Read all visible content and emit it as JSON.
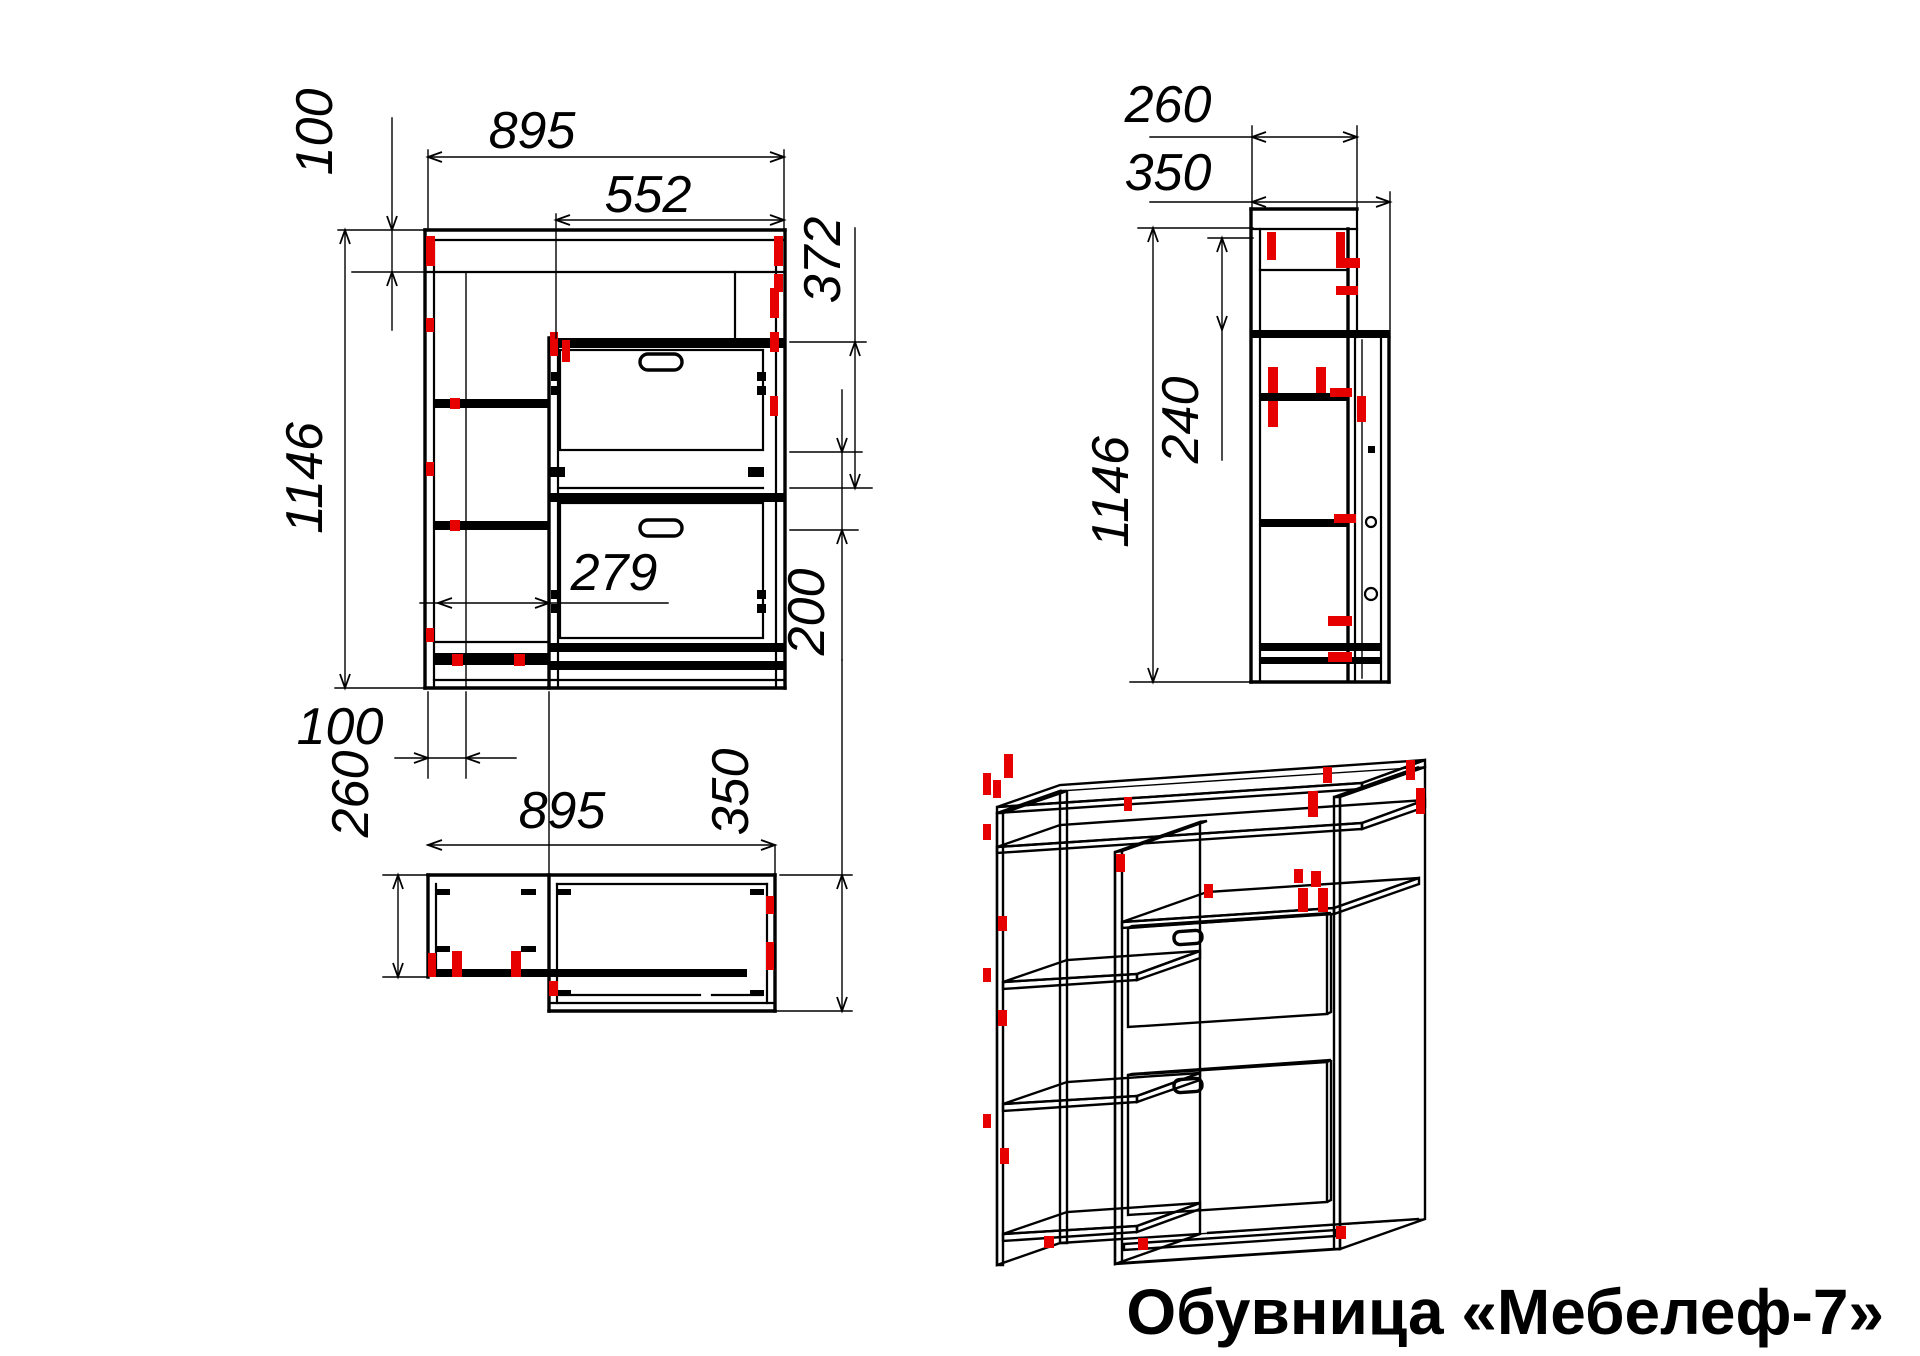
{
  "title": "Обувница «Мебелеф-7»",
  "colors": {
    "line": "#000000",
    "accent": "#e60000",
    "background": "#ffffff"
  },
  "views": {
    "front": {
      "label": "front-view",
      "dims": {
        "overall_width": "895",
        "drawer_section_width": "552",
        "top_inset": "100",
        "overall_height": "1146",
        "flap_height": "372",
        "lower_gap": "200",
        "shelf_clear_width": "279",
        "base_inset": "100"
      }
    },
    "plan": {
      "label": "top-view",
      "dims": {
        "left_depth": "260",
        "overall_width": "895",
        "right_depth": "350"
      }
    },
    "side": {
      "label": "side-view",
      "dims": {
        "top_depth": "260",
        "overall_depth": "350",
        "overall_height": "1146",
        "top_section_height": "240"
      }
    },
    "iso": {
      "label": "isometric-view"
    }
  }
}
